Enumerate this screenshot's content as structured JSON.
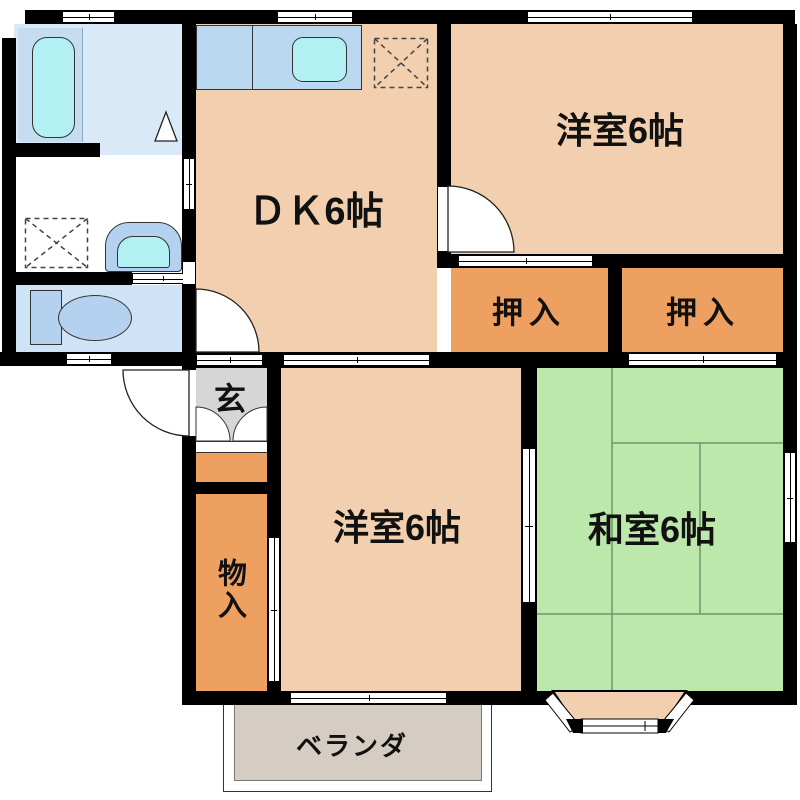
{
  "rooms": {
    "dk": "ＤＫ6帖",
    "western_top": "洋室6帖",
    "western_bottom": "洋室6帖",
    "japanese": "和室6帖",
    "closet_left": "押入",
    "closet_right": "押入",
    "storage": "物入",
    "entrance": "玄",
    "veranda": "ベランダ"
  },
  "colors": {
    "wall": "#000000",
    "floor_peach": "#f2cfae",
    "closet_orange": "#eea061",
    "tatami_green": "#bce8ac",
    "tatami_line": "#72946a",
    "genkan_gray": "#d6d6d6",
    "veranda_gray": "#d5ccc4",
    "bath_floor": "#d9e9f8",
    "bath_panel": "#c6dcf1",
    "water_cyan": "#b2f0f4",
    "fixture_blue": "#b4d2ef",
    "counter_blue": "#bad8ef",
    "toilet_floor": "#cfe3f6"
  }
}
